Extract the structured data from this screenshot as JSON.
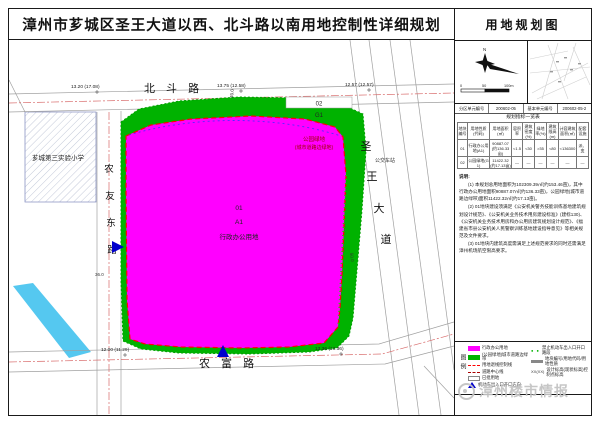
{
  "title": "漳州市芗城区圣王大道以西、北斗路以南用地控制性详细规划",
  "colors": {
    "parcel_magenta": "#FF00FF",
    "park_green": "#00B200",
    "setback_red": "#FF0000",
    "road_line": "#A0A0A0",
    "centerline_red": "#D86A6A",
    "river_blue": "#55C8F0",
    "access_arrow_blue": "#0000CC",
    "watermark_gray": "#C4C4C4"
  },
  "map": {
    "roads": {
      "north": "北 斗 路",
      "south": "农 富 路",
      "east_chars": [
        "圣",
        "王",
        "大",
        "道"
      ],
      "west_chars": [
        "农",
        "友",
        "东",
        "路"
      ]
    },
    "labels": {
      "school": "芗城第三实验小学",
      "bus_stop": "公交车站",
      "parcel01_no": "01",
      "parcel01_code": "A1",
      "parcel01_use": "行政办公用地",
      "parcel02_no": "02",
      "parcel02_code": "G1",
      "green_label1": "公园绿地",
      "green_label2": "(城市道路边绿地)"
    },
    "elevations": {
      "nw": "13.20 (17.08)",
      "n": "13.75 (12.58)",
      "ne": "12.57 (12.57)",
      "sw": "12.00 (11.29)",
      "se": "13.36 (13.36)"
    },
    "dimensions": {
      "west": "36.0",
      "north": "40.0",
      "east": "50.0"
    }
  },
  "sidebar": {
    "map_title": "用地规划图",
    "compass_n": "N",
    "scale": {
      "t0": "0",
      "t1": "50",
      "t2": "100m"
    },
    "units": {
      "l1": "分区单元编号",
      "v1": "200602-05",
      "l2": "基本单元编号",
      "v2": "200602-05-2"
    },
    "table": {
      "title": "规划指标一览表",
      "headers": [
        "地块编号",
        "用地性质(代码)",
        "用地面积(㎡)",
        "容积率",
        "建筑密度(%)",
        "绿地率(%)",
        "建筑限高(m)",
        "计容建筑面积(㎡)",
        "配套设施"
      ],
      "rows": [
        [
          "01",
          "行政办公用地(A1)",
          "90887.07 (约136.33亩)",
          "<1.5",
          "<30",
          ">35",
          "<80",
          "<136300",
          "派、变"
        ],
        [
          "02",
          "公园绿地(G1)",
          "11422.32 (约17.13亩)",
          "—",
          "—",
          "—",
          "—",
          "—",
          "—"
        ]
      ]
    },
    "notes_title": "说明:",
    "notes": [
      "(1) 本规划总用地面积为102309.39㎡(约153.46亩)，其中行政办公用地面积90887.07㎡(约136.33亩)，公园绿地(城市道路边绿带)面积11422.32㎡(约17.13亩)。",
      "(2) 01地块建设须满足《公安机关警务技能训练基地建筑规划设计规范》、《公安机关业务技术用房建设标准》(建标130)、《公安机关业务技术用房和办公用房建筑规划设计规范》、《福建省市县公安机关人民警察训练基地建设指导意见》等相关规范及文件要求。",
      "(3) 01地块内建筑高度需满足上述规范要求的同时还需满足漳州机场航空限高要求。"
    ],
    "legend": {
      "heading": "图例",
      "left": [
        {
          "label": "行政办公用地"
        },
        {
          "label": "(公园绿地)城市道路边绿带"
        },
        {
          "label": "用地退线控制线"
        },
        {
          "label": "道路中心线"
        },
        {
          "label": "已批用地"
        },
        {
          "label": "机动车出入口开口方向"
        }
      ],
      "right": [
        {
          "label": "禁止机动车出入口开口路段"
        },
        {
          "label1": "地块编号",
          "label2": "用地代码",
          "label3": "用地性质"
        },
        {
          "symbol": "XX(XX)",
          "label": "设计标高(现状标高)控制点标高"
        }
      ]
    },
    "watermark": "漳州楼市情报"
  }
}
